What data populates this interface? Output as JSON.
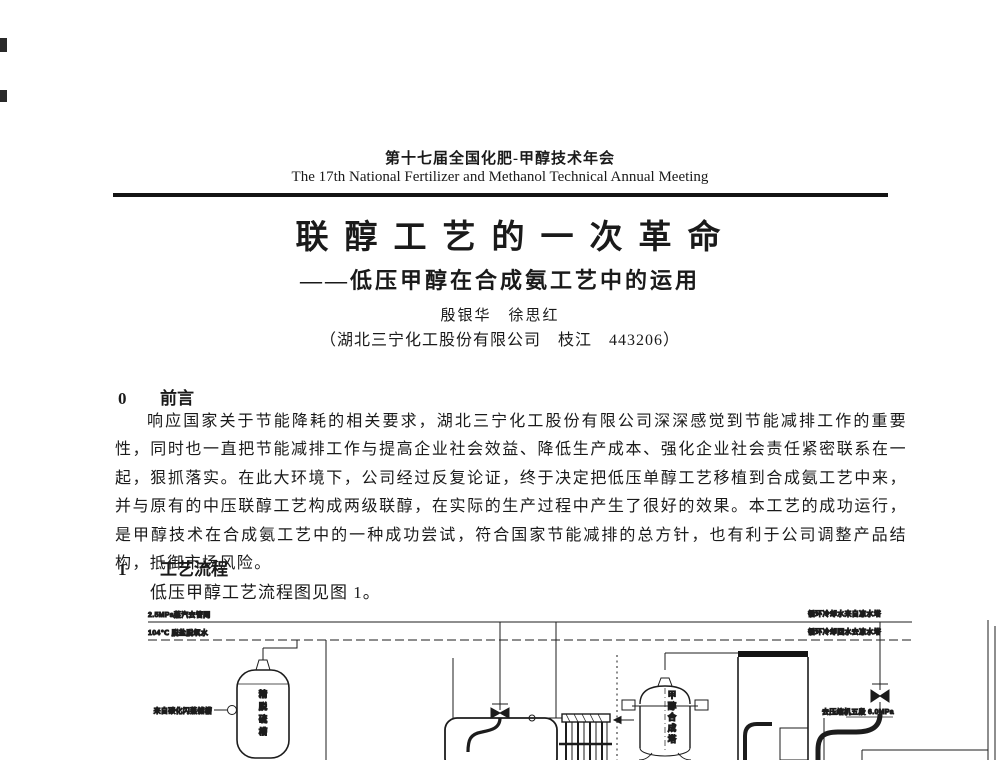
{
  "header": {
    "meeting_cn": "第十七届全国化肥-甲醇技术年会",
    "meeting_en": "The 17th National Fertilizer and Methanol Technical Annual Meeting"
  },
  "title": {
    "main": "联醇工艺的一次革命",
    "subtitle": "——低压甲醇在合成氨工艺中的运用",
    "authors": "殷银华　徐思红",
    "affiliation": "（湖北三宁化工股份有限公司　枝江　443206）"
  },
  "sections": {
    "s0": {
      "number": "0",
      "heading": "前言",
      "body": "响应国家关于节能降耗的相关要求，湖北三宁化工股份有限公司深深感觉到节能减排工作的重要性，同时也一直把节能减排工作与提高企业社会效益、降低生产成本、强化企业社会责任紧密联系在一起，狠抓落实。在此大环境下，公司经过反复论证，终于决定把低压单醇工艺移植到合成氨工艺中来，并与原有的中压联醇工艺构成两级联醇，在实际的生产过程中产生了很好的效果。本工艺的成功运行，是甲醇技术在合成氨工艺中的一种成功尝试，符合国家节能减排的总方针，也有利于公司调整产品结构，抵御市场风险。"
    },
    "s1": {
      "number": "1",
      "heading": "工艺流程",
      "body": "低压甲醇工艺流程图见图 1。"
    }
  },
  "diagram": {
    "steam_line_label": "2.5MPa蒸汽去管网",
    "water_line_label": "104℃ 脱盐脱氧水",
    "cooling_supply_label": "循环冷却水来自凉水塔",
    "cooling_return_label": "循环冷却回水去凉水塔",
    "feed_label": "来自碳化闪蒸储槽",
    "to_compressor_label": "去压缩机五段 6.0MPa",
    "column_label": "精脱硫槽",
    "reactor_label": "甲醇合成塔",
    "ink_color": "#1c1c1c"
  }
}
